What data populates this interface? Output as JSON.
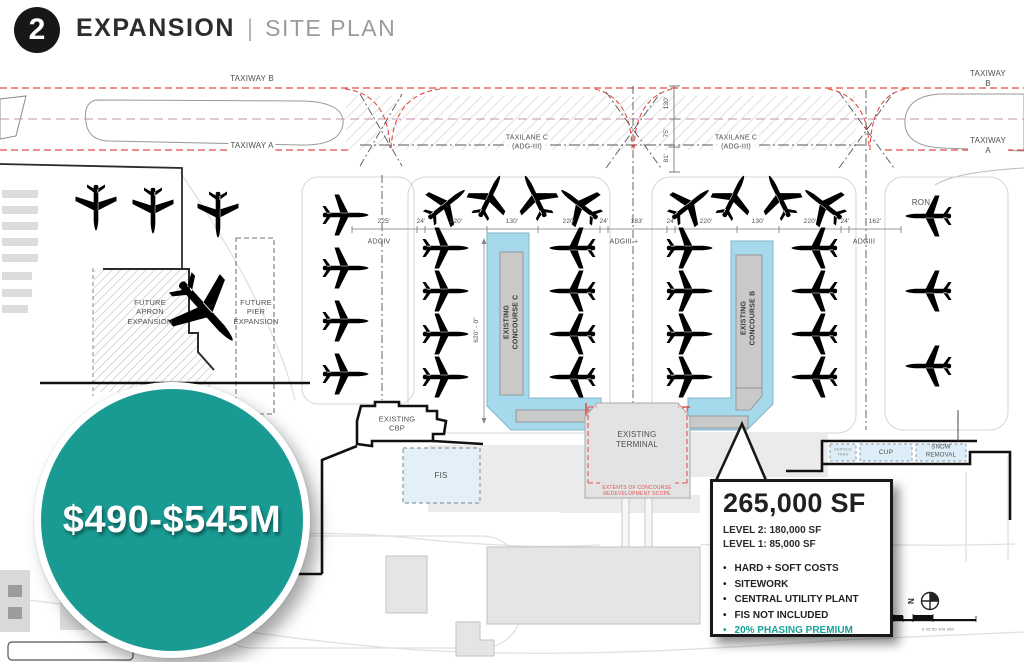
{
  "header": {
    "badge": "2",
    "title": "EXPANSION",
    "divider": "|",
    "subtitle": "SITE PLAN"
  },
  "cost_bubble": {
    "label": "$490-$545M",
    "color": "#199a93"
  },
  "callout": {
    "title": "265,000 SF",
    "levels": "LEVEL 2: 180,000 SF\nLEVEL 1: 85,000 SF",
    "bullets": [
      {
        "text": "HARD + SOFT COSTS",
        "color": "#231f20"
      },
      {
        "text": "SITEWORK",
        "color": "#231f20"
      },
      {
        "text": "CENTRAL UTILITY PLANT",
        "color": "#231f20"
      },
      {
        "text": "FIS NOT INCLUDED",
        "color": "#231f20"
      },
      {
        "text": "20% PHASING PREMIUM",
        "color": "#17a398"
      }
    ]
  },
  "plan": {
    "labels": [
      {
        "id": "taxiway-b-left",
        "t": "TAXIWAY B",
        "x": 252,
        "y": 79,
        "s": 8
      },
      {
        "id": "taxiway-b-right",
        "t": "TAXIWAY B",
        "x": 988,
        "y": 79,
        "s": 8
      },
      {
        "id": "taxiway-a-left",
        "t": "TAXIWAY A",
        "x": 252,
        "y": 146,
        "s": 8,
        "b": "#fff"
      },
      {
        "id": "taxiway-a-right",
        "t": "TAXIWAY A",
        "x": 988,
        "y": 146,
        "s": 8,
        "b": "#fff"
      },
      {
        "id": "taxilane-c-left",
        "t": "TAXILANE C\n(ADG-III)",
        "x": 527,
        "y": 143,
        "s": 7,
        "b": "rgba(255,255,255,.85)"
      },
      {
        "id": "taxilane-c-right",
        "t": "TAXILANE C\n(ADG-III)",
        "x": 736,
        "y": 143,
        "s": 7,
        "b": "rgba(255,255,255,.85)"
      },
      {
        "id": "dim-130-vert",
        "t": "130'",
        "x": 667,
        "y": 103,
        "s": 6.5,
        "r": -90
      },
      {
        "id": "dim-75-vert",
        "t": "75'",
        "x": 667,
        "y": 133,
        "s": 6.5,
        "r": -90
      },
      {
        "id": "dim-81-vert",
        "t": "81'",
        "x": 667,
        "y": 158,
        "s": 6.5,
        "r": -90
      },
      {
        "id": "dim-225",
        "t": "225'",
        "x": 384,
        "y": 222,
        "s": 6.5
      },
      {
        "id": "dim-24a",
        "t": "24'",
        "x": 421,
        "y": 222,
        "s": 6.5
      },
      {
        "id": "dim-220a",
        "t": "220'",
        "x": 456,
        "y": 222,
        "s": 6.5
      },
      {
        "id": "dim-130a",
        "t": "130'",
        "x": 512,
        "y": 222,
        "s": 6.5
      },
      {
        "id": "dim-220b",
        "t": "220'",
        "x": 569,
        "y": 222,
        "s": 6.5
      },
      {
        "id": "dim-24b",
        "t": "24'",
        "x": 604,
        "y": 222,
        "s": 6.5
      },
      {
        "id": "dim-183",
        "t": "183'",
        "x": 637,
        "y": 222,
        "s": 6.5
      },
      {
        "id": "dim-24c",
        "t": "24'",
        "x": 671,
        "y": 222,
        "s": 6.5
      },
      {
        "id": "dim-220c",
        "t": "220'",
        "x": 706,
        "y": 222,
        "s": 6.5
      },
      {
        "id": "dim-130b",
        "t": "130'",
        "x": 758,
        "y": 222,
        "s": 6.5
      },
      {
        "id": "dim-220d",
        "t": "220'",
        "x": 810,
        "y": 222,
        "s": 6.5
      },
      {
        "id": "dim-24d",
        "t": "24'",
        "x": 845,
        "y": 222,
        "s": 6.5
      },
      {
        "id": "dim-162",
        "t": "162'",
        "x": 875,
        "y": 222,
        "s": 6.5
      },
      {
        "id": "adg-iv",
        "t": "ADGIV",
        "x": 379,
        "y": 243,
        "s": 7
      },
      {
        "id": "adg-iii-plus",
        "t": "ADGIII +",
        "x": 624,
        "y": 243,
        "s": 7
      },
      {
        "id": "adg-iii",
        "t": "ADGIII",
        "x": 864,
        "y": 243,
        "s": 7
      },
      {
        "id": "ron",
        "t": "RON",
        "x": 921,
        "y": 203,
        "s": 8
      },
      {
        "id": "dim-620",
        "t": "620' - 0\"",
        "x": 477,
        "y": 330,
        "s": 6.5,
        "r": -90
      },
      {
        "id": "concourse-c-label",
        "t": "EXISTING\nCONCOURSE C",
        "x": 512,
        "y": 322,
        "s": 7,
        "r": -90,
        "w": "bold",
        "c": "#3a3a3a"
      },
      {
        "id": "concourse-b-label",
        "t": "EXISTING\nCONCOURSE B",
        "x": 749,
        "y": 318,
        "s": 7,
        "r": -90,
        "w": "bold",
        "c": "#3a3a3a"
      },
      {
        "id": "future-apron",
        "t": "FUTURE\nAPRON\nEXPANSION",
        "x": 150,
        "y": 312,
        "s": 7.5
      },
      {
        "id": "future-pier",
        "t": "FUTURE\nPIER\nEXPANSION",
        "x": 256,
        "y": 312,
        "s": 7.5
      },
      {
        "id": "existing-cbp",
        "t": "EXISTING\nCBP",
        "x": 397,
        "y": 424,
        "s": 7.5
      },
      {
        "id": "fis",
        "t": "FIS",
        "x": 441,
        "y": 476,
        "s": 8
      },
      {
        "id": "existing-terminal",
        "t": "EXISTING\nTERMINAL",
        "x": 637,
        "y": 440,
        "s": 8
      },
      {
        "id": "extents-note",
        "t": "EXTENTS OF CONCOURSE\nREDEVELOPMENT SCOPE",
        "x": 637,
        "y": 491,
        "s": 5,
        "c": "#e05555"
      },
      {
        "id": "cup",
        "t": "CUP",
        "x": 886,
        "y": 453,
        "s": 6.5
      },
      {
        "id": "snow-removal",
        "t": "SNOW\nREMOVAL",
        "x": 941,
        "y": 452,
        "s": 6
      },
      {
        "id": "service-yard",
        "t": "SERVICE\nYARD",
        "x": 843,
        "y": 452,
        "s": 3.8,
        "c": "#888888"
      },
      {
        "id": "north-n",
        "t": "N",
        "x": 912,
        "y": 601,
        "s": 8,
        "r": -90,
        "w": "bold",
        "c": "#222222"
      },
      {
        "id": "scale-numbers",
        "t": "0  25  50      100              200",
        "x": 938,
        "y": 629,
        "s": 4,
        "c": "#666666"
      }
    ],
    "planes": [
      {
        "x": 447,
        "y": 204,
        "r": -38,
        "st": "d"
      },
      {
        "x": 490,
        "y": 196,
        "r": -64,
        "st": "d"
      },
      {
        "x": 535,
        "y": 196,
        "r": -116,
        "st": "d"
      },
      {
        "x": 579,
        "y": 204,
        "r": -142,
        "st": "d"
      },
      {
        "x": 446,
        "y": 248,
        "r": 0,
        "st": "d"
      },
      {
        "x": 446,
        "y": 291,
        "r": 0,
        "st": "d"
      },
      {
        "x": 446,
        "y": 334,
        "r": 0,
        "st": "d"
      },
      {
        "x": 446,
        "y": 377,
        "r": 0,
        "st": "d"
      },
      {
        "x": 572,
        "y": 248,
        "r": 180,
        "st": "d"
      },
      {
        "x": 572,
        "y": 291,
        "r": 180,
        "st": "d"
      },
      {
        "x": 572,
        "y": 334,
        "r": 180,
        "st": "d"
      },
      {
        "x": 572,
        "y": 377,
        "r": 180,
        "st": "d"
      },
      {
        "x": 691,
        "y": 204,
        "r": -38,
        "st": "d"
      },
      {
        "x": 734,
        "y": 196,
        "r": -64,
        "st": "d"
      },
      {
        "x": 779,
        "y": 196,
        "r": -116,
        "st": "d"
      },
      {
        "x": 823,
        "y": 204,
        "r": -142,
        "st": "d"
      },
      {
        "x": 690,
        "y": 248,
        "r": 0,
        "st": "d"
      },
      {
        "x": 690,
        "y": 291,
        "r": 0,
        "st": "d"
      },
      {
        "x": 690,
        "y": 334,
        "r": 0,
        "st": "d"
      },
      {
        "x": 690,
        "y": 377,
        "r": 0,
        "st": "d"
      },
      {
        "x": 814,
        "y": 248,
        "r": 180,
        "st": "d"
      },
      {
        "x": 814,
        "y": 291,
        "r": 180,
        "st": "d"
      },
      {
        "x": 814,
        "y": 334,
        "r": 180,
        "st": "d"
      },
      {
        "x": 814,
        "y": 377,
        "r": 180,
        "st": "d"
      },
      {
        "x": 346,
        "y": 215,
        "r": 0,
        "st": "r"
      },
      {
        "x": 346,
        "y": 268,
        "r": 0,
        "st": "r"
      },
      {
        "x": 346,
        "y": 321,
        "r": 0,
        "st": "r"
      },
      {
        "x": 346,
        "y": 374,
        "r": 0,
        "st": "r"
      },
      {
        "x": 96,
        "y": 208,
        "r": 90,
        "st": "f"
      },
      {
        "x": 153,
        "y": 211,
        "r": 90,
        "st": "f"
      },
      {
        "x": 218,
        "y": 215,
        "r": 90,
        "st": "f"
      },
      {
        "x": 207,
        "y": 312,
        "r": 48,
        "st": "f",
        "sc": 1.7
      },
      {
        "x": 928,
        "y": 216,
        "r": 180,
        "st": "f"
      },
      {
        "x": 928,
        "y": 291,
        "r": 180,
        "st": "f"
      },
      {
        "x": 928,
        "y": 366,
        "r": 180,
        "st": "f"
      }
    ]
  }
}
